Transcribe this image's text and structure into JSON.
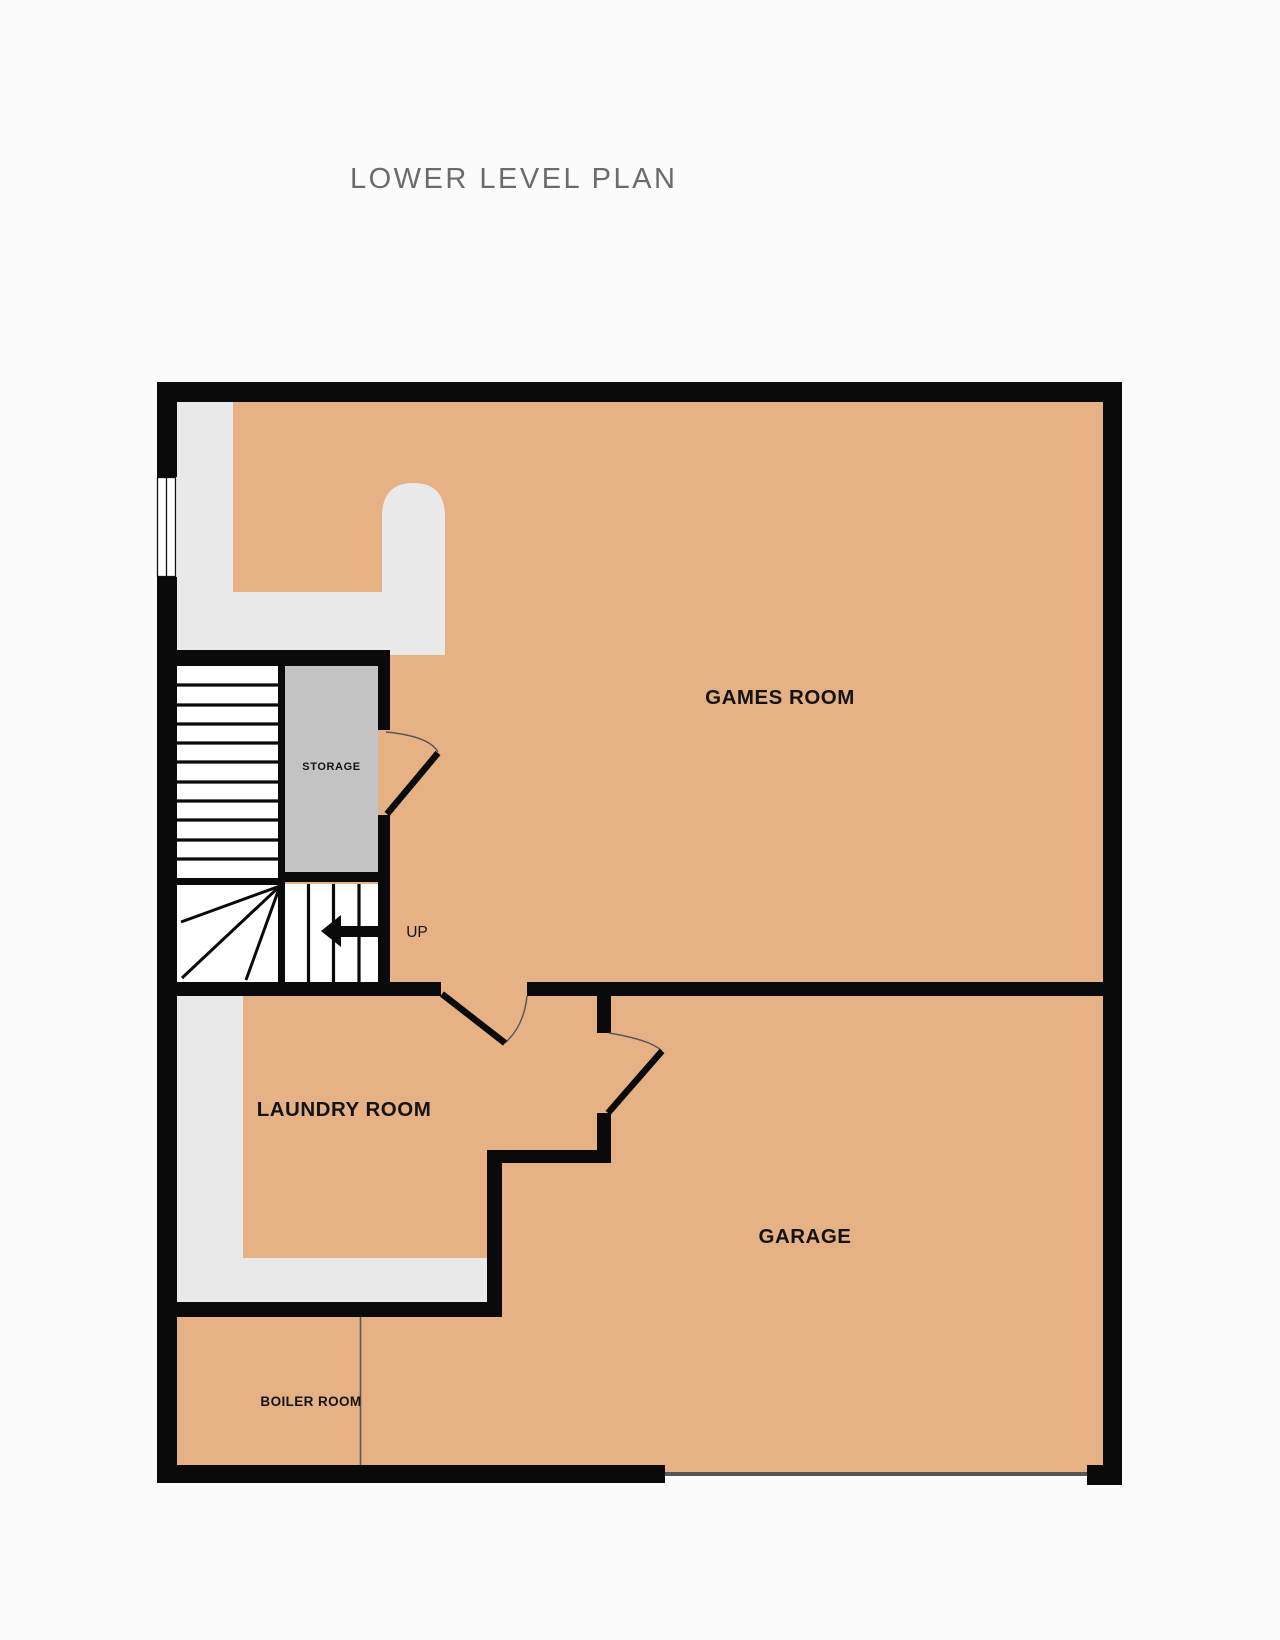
{
  "page": {
    "title": "LOWER LEVEL PLAN"
  },
  "plan": {
    "rooms": [
      {
        "id": "games-room",
        "label": "GAMES ROOM"
      },
      {
        "id": "storage",
        "label": "STORAGE"
      },
      {
        "id": "laundry-room",
        "label": "LAUNDRY ROOM"
      },
      {
        "id": "garage",
        "label": "GARAGE"
      },
      {
        "id": "boiler-room",
        "label": "BOILER ROOM"
      }
    ],
    "stairs": {
      "direction_label": "UP"
    }
  },
  "colors": {
    "floor": "#e6b185",
    "corridor": "#e9e9e9",
    "storage": "#c3c3c3",
    "wall": "#0a0a0a",
    "thin": "#565656",
    "title_text": "#6b6b6b",
    "label_text": "#141414",
    "background": "#fbfbfb"
  }
}
